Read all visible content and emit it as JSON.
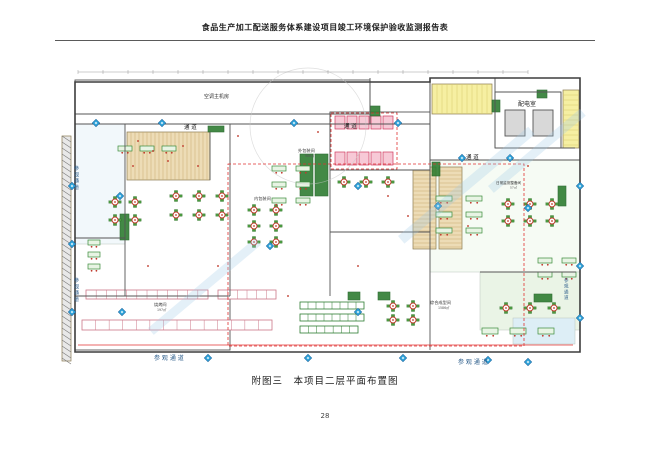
{
  "page": {
    "header_title": "食品生产加工配送服务体系建设项目竣工环境保护验收监测报告表",
    "caption": "附图三　本项目二层平面布置图",
    "page_number": "28"
  },
  "floorplan": {
    "colors": {
      "wall": "#555555",
      "outer_wall": "#3d3d3d",
      "label": "#222222",
      "visitor_label": "#2b5c8a",
      "marker_fill": "#35a8dc",
      "marker_edge": "#1565a0",
      "table_red": "#c0392b",
      "seat_green": "#4a9a3f",
      "machine_green": "#2f7d32",
      "tan_fill": "#eddcb6",
      "tan_line": "#c9a96e",
      "yellow_fill": "#f6efa2",
      "yellow_line": "#d8c86a",
      "stall_fill": "#f7c9d6",
      "stall_edge": "#cf3a5e",
      "red_zone": "#e03030",
      "watermark": "#9ec9e6"
    },
    "labels": [
      {
        "t": "通  道",
        "x": 126,
        "y": 63,
        "fs": 5.5,
        "c": "#222222"
      },
      {
        "t": "通  道",
        "x": 286,
        "y": 62,
        "fs": 5.5,
        "c": "#222222"
      },
      {
        "t": "通  道",
        "x": 408,
        "y": 93,
        "fs": 5.5,
        "c": "#222222"
      },
      {
        "t": "配电室",
        "x": 460,
        "y": 40,
        "fs": 6,
        "c": "#222222"
      },
      {
        "t": "空调主机房",
        "x": 146,
        "y": 32,
        "fs": 5,
        "c": "#333333"
      },
      {
        "t": "外包装间",
        "x": 240,
        "y": 86,
        "fs": 4.2,
        "c": "#333333"
      },
      {
        "t": "986㎡",
        "x": 247,
        "y": 91,
        "fs": 3.2,
        "c": "#555555"
      },
      {
        "t": "内包装间",
        "x": 196,
        "y": 134,
        "fs": 4.2,
        "c": "#333333"
      },
      {
        "t": "综合成型间",
        "x": 372,
        "y": 238,
        "fs": 4.2,
        "c": "#333333"
      },
      {
        "t": "1586㎡",
        "x": 380,
        "y": 243,
        "fs": 3.2,
        "c": "#555555"
      },
      {
        "t": "烧烤间",
        "x": 96,
        "y": 240,
        "fs": 4.2,
        "c": "#333333"
      },
      {
        "t": "197㎡",
        "x": 99,
        "y": 245,
        "fs": 3.2,
        "c": "#555555"
      },
      {
        "t": "日常监测整备间",
        "x": 438,
        "y": 118,
        "fs": 3.6,
        "c": "#333333"
      },
      {
        "t": "57㎡",
        "x": 452,
        "y": 122.5,
        "fs": 3,
        "c": "#555555"
      },
      {
        "t": "参 观 通 道",
        "x": 96,
        "y": 294,
        "fs": 6,
        "c": "#2b5c8a"
      },
      {
        "t": "参 观 通 道",
        "x": 400,
        "y": 298,
        "fs": 6,
        "c": "#2b5c8a"
      },
      {
        "t": "参观通道",
        "x": 16,
        "y": 104,
        "fs": 5,
        "c": "#2b5c8a",
        "v": true
      },
      {
        "t": "参观通道",
        "x": 16,
        "y": 216,
        "fs": 5,
        "c": "#2b5c8a",
        "v": true
      },
      {
        "t": "参观通道",
        "x": 506,
        "y": 216,
        "fs": 4.5,
        "c": "#2b5c8a",
        "v": true
      }
    ],
    "pale_rooms": [
      {
        "x": 17,
        "y": 58,
        "w": 50,
        "h": 120,
        "f": "#f2f8fb"
      },
      {
        "x": 372,
        "y": 94,
        "w": 150,
        "h": 112,
        "f": "#f6fbf4"
      },
      {
        "x": 422,
        "y": 206,
        "w": 100,
        "h": 58,
        "f": "#eaf4e6"
      },
      {
        "x": 455,
        "y": 252,
        "w": 62,
        "h": 26,
        "f": "#ddeef6"
      }
    ],
    "hatches": [
      {
        "x": 69,
        "y": 66,
        "w": 83,
        "h": 48,
        "f": "#eddcb6",
        "l": "#c9a96e",
        "dir": "v",
        "step": 4
      },
      {
        "x": 355,
        "y": 101,
        "w": 23,
        "h": 82,
        "f": "#eddcb6",
        "l": "#c9a96e",
        "dir": "h",
        "step": 4
      },
      {
        "x": 381,
        "y": 101,
        "w": 23,
        "h": 82,
        "f": "#eddcb6",
        "l": "#c9a96e",
        "dir": "h",
        "step": 4
      },
      {
        "x": 374,
        "y": 18,
        "w": 60,
        "h": 30,
        "f": "#f6efa2",
        "l": "#d8c86a",
        "dir": "v",
        "step": 5
      },
      {
        "x": 505,
        "y": 24,
        "w": 16,
        "h": 58,
        "f": "#f6efa2",
        "l": "#d8c86a",
        "dir": "h",
        "step": 5
      },
      {
        "x": 4,
        "y": 70,
        "w": 9,
        "h": 225,
        "f": "#e8e8e8",
        "l": "#777777",
        "dir": "d",
        "step": 6
      }
    ],
    "rooms": [
      {
        "x": 17,
        "y": 14,
        "w": 295,
        "h": 34
      },
      {
        "x": 312,
        "y": 16,
        "w": 60,
        "h": 40
      },
      {
        "x": 437,
        "y": 26,
        "w": 66,
        "h": 56
      },
      {
        "x": 447,
        "y": 44,
        "w": 20,
        "h": 26,
        "f": "#d8d8d8"
      },
      {
        "x": 475,
        "y": 44,
        "w": 20,
        "h": 26,
        "f": "#d8d8d8"
      },
      {
        "x": 272,
        "y": 46,
        "w": 100,
        "h": 58
      },
      {
        "x": 17,
        "y": 230,
        "w": 155,
        "h": 54
      }
    ],
    "stall_rows": [
      {
        "x": 277,
        "y": 50,
        "n": 5,
        "dx": 12,
        "w": 10,
        "h": 13
      },
      {
        "x": 277,
        "y": 86,
        "n": 5,
        "dx": 12,
        "w": 10,
        "h": 13
      }
    ],
    "machines": [
      [
        242,
        88,
        13,
        42
      ],
      [
        257,
        88,
        13,
        42
      ],
      [
        62,
        148,
        9,
        26
      ],
      [
        374,
        96,
        8,
        14
      ],
      [
        312,
        40,
        10,
        10
      ],
      [
        434,
        34,
        8,
        12
      ],
      [
        479,
        24,
        10,
        8
      ],
      [
        500,
        120,
        8,
        20
      ],
      [
        290,
        226,
        12,
        8
      ],
      [
        320,
        226,
        12,
        8
      ],
      [
        150,
        60,
        16,
        6
      ],
      [
        476,
        228,
        18,
        8
      ]
    ],
    "equip_rows": [
      {
        "x": 28,
        "y": 224,
        "w": 122,
        "h": 9,
        "ticks": 12,
        "c": "#cc7788"
      },
      {
        "x": 160,
        "y": 224,
        "w": 58,
        "h": 9,
        "ticks": 6,
        "c": "#cc7788"
      },
      {
        "x": 24,
        "y": 254,
        "w": 190,
        "h": 10,
        "ticks": 14,
        "c": "#cc7788"
      },
      {
        "x": 242,
        "y": 236,
        "w": 64,
        "h": 7,
        "ticks": 8,
        "c": "#2e7d32"
      },
      {
        "x": 242,
        "y": 248,
        "w": 64,
        "h": 7,
        "ticks": 8,
        "c": "#2e7d32"
      },
      {
        "x": 242,
        "y": 260,
        "w": 58,
        "h": 7,
        "ticks": 7,
        "c": "#2e7d32"
      }
    ],
    "table_clusters": [
      {
        "x": 57,
        "y": 136,
        "cols": 2,
        "rows": 2,
        "dx": 20,
        "dy": 18
      },
      {
        "x": 118,
        "y": 130,
        "cols": 3,
        "rows": 2,
        "dx": 23,
        "dy": 19
      },
      {
        "x": 196,
        "y": 144,
        "cols": 2,
        "rows": 3,
        "dx": 22,
        "dy": 16
      },
      {
        "x": 286,
        "y": 116,
        "cols": 3,
        "rows": 1,
        "dx": 22,
        "dy": 0
      },
      {
        "x": 450,
        "y": 138,
        "cols": 3,
        "rows": 2,
        "dx": 22,
        "dy": 17
      },
      {
        "x": 335,
        "y": 240,
        "cols": 2,
        "rows": 2,
        "dx": 20,
        "dy": 14
      },
      {
        "x": 448,
        "y": 242,
        "cols": 3,
        "rows": 1,
        "dx": 24,
        "dy": 0
      }
    ],
    "desk_clusters": [
      {
        "x": 30,
        "y": 174,
        "cols": 1,
        "rows": 3,
        "dx": 0,
        "dy": 12,
        "w": 12,
        "h": 5
      },
      {
        "x": 214,
        "y": 100,
        "cols": 2,
        "rows": 3,
        "dx": 24,
        "dy": 16,
        "w": 14,
        "h": 5
      },
      {
        "x": 378,
        "y": 130,
        "cols": 2,
        "rows": 3,
        "dx": 30,
        "dy": 16,
        "w": 16,
        "h": 5
      },
      {
        "x": 424,
        "y": 262,
        "cols": 3,
        "rows": 1,
        "dx": 28,
        "dy": 0,
        "w": 16,
        "h": 6
      },
      {
        "x": 60,
        "y": 80,
        "cols": 3,
        "rows": 1,
        "dx": 22,
        "dy": 0,
        "w": 14,
        "h": 5
      },
      {
        "x": 480,
        "y": 192,
        "cols": 2,
        "rows": 2,
        "dx": 24,
        "dy": 14,
        "w": 14,
        "h": 5
      }
    ],
    "red_dots": [
      [
        80,
        75
      ],
      [
        95,
        85
      ],
      [
        110,
        95
      ],
      [
        125,
        80
      ],
      [
        140,
        100
      ],
      [
        75,
        100
      ],
      [
        180,
        70
      ],
      [
        260,
        66
      ],
      [
        330,
        130
      ],
      [
        350,
        150
      ],
      [
        410,
        160
      ],
      [
        470,
        100
      ],
      [
        300,
        200
      ],
      [
        230,
        230
      ],
      [
        160,
        200
      ],
      [
        90,
        200
      ]
    ],
    "markers": [
      [
        38,
        57
      ],
      [
        104,
        57
      ],
      [
        236,
        57
      ],
      [
        340,
        57
      ],
      [
        404,
        92
      ],
      [
        452,
        92
      ],
      [
        14,
        120
      ],
      [
        14,
        178
      ],
      [
        14,
        246
      ],
      [
        62,
        130
      ],
      [
        300,
        120
      ],
      [
        380,
        140
      ],
      [
        470,
        142
      ],
      [
        64,
        246
      ],
      [
        150,
        292
      ],
      [
        250,
        292
      ],
      [
        345,
        292
      ],
      [
        430,
        294
      ],
      [
        470,
        296
      ],
      [
        522,
        120
      ],
      [
        522,
        200
      ],
      [
        522,
        252
      ],
      [
        212,
        180
      ],
      [
        300,
        246
      ]
    ],
    "walls": [
      [
        17,
        48,
        312,
        48
      ],
      [
        17,
        58,
        372,
        58
      ],
      [
        312,
        12,
        312,
        58
      ],
      [
        372,
        12,
        372,
        58
      ],
      [
        437,
        12,
        437,
        82
      ],
      [
        437,
        82,
        517,
        82
      ],
      [
        372,
        94,
        522,
        94
      ],
      [
        372,
        58,
        372,
        284
      ],
      [
        272,
        46,
        272,
        230
      ],
      [
        172,
        58,
        172,
        230
      ],
      [
        67,
        58,
        67,
        230
      ],
      [
        17,
        230,
        172,
        230
      ],
      [
        17,
        172,
        67,
        172
      ],
      [
        152,
        66,
        152,
        114
      ],
      [
        272,
        104,
        372,
        104
      ],
      [
        272,
        166,
        372,
        166
      ],
      [
        422,
        206,
        518,
        206
      ],
      [
        437,
        26,
        503,
        26
      ],
      [
        503,
        26,
        503,
        82
      ]
    ],
    "outer_path": "M17,16 H372 V12 H522 V286 H17 Z",
    "red_dashed": [
      {
        "x": 170,
        "y": 98,
        "w": 296,
        "h": 182
      },
      {
        "x": 273,
        "y": 47,
        "w": 66,
        "h": 56
      }
    ],
    "red_lines": [
      [
        20,
        279,
        515,
        279
      ]
    ],
    "watermark_bars": [
      {
        "x": 340,
        "y": 170,
        "rot": -40,
        "w": 170,
        "h": 10
      },
      {
        "x": 90,
        "y": 262,
        "rot": -40,
        "w": 140,
        "h": 9
      },
      {
        "x": 430,
        "y": 120,
        "rot": -40,
        "w": 120,
        "h": 9
      }
    ],
    "ref_circle": {
      "cx": 250,
      "cy": 60,
      "r": 58
    },
    "dim_ticks": {
      "x0": 20,
      "x1": 470,
      "y": 6,
      "step": 25
    }
  }
}
